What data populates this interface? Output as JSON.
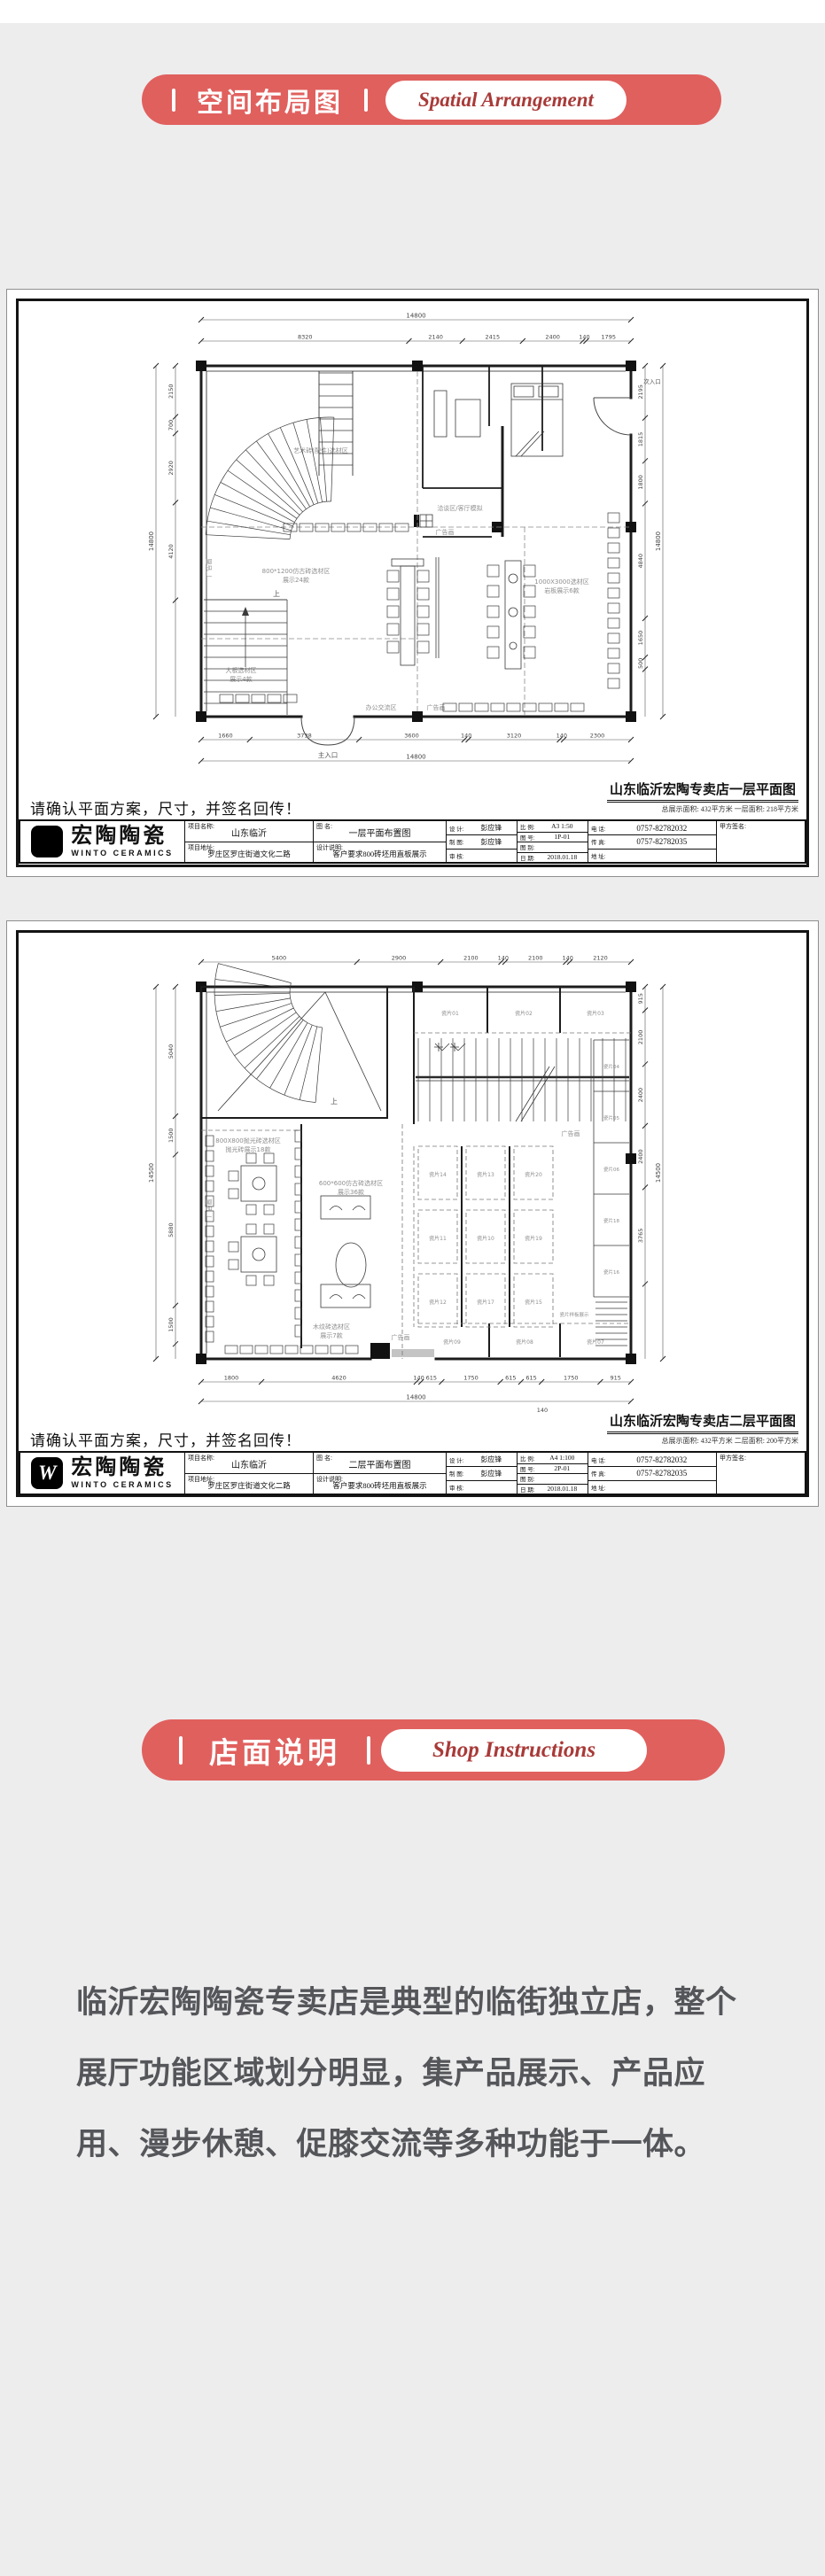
{
  "page": {
    "bg": "#ededee"
  },
  "colors": {
    "accent": "#e0605e",
    "accent_text": "#a83a38",
    "paragraph_text": "#55565a"
  },
  "banner_spatial": {
    "title_zh": "空间布局图",
    "title_en": "Spatial Arrangement"
  },
  "banner_shop": {
    "title_zh": "店面说明",
    "title_en": "Shop Instructions"
  },
  "company": {
    "name_zh": "宏陶陶瓷",
    "name_en": "WINTO CERAMICS",
    "logo_letter": "W"
  },
  "tbl": {
    "project_name": "项目名称:",
    "project_addr": "项目地址:",
    "drawing_name": "图  名:",
    "design_note": "设计说明:",
    "design": "设 计:",
    "draft": "制 图:",
    "review": "审 核:",
    "scale": "比 例:",
    "sheet_no": "图 号:",
    "sheet_type": "图 别:",
    "date": "日 期:",
    "phone": "电 话:",
    "fax": "传 真:",
    "addr": "地 址:",
    "client_sign": "甲方签名:"
  },
  "sheet1": {
    "confirm_note": "请确认平面方案，尺寸，并签名回传！",
    "drawing_title": "山东临沂宏陶专卖店一层平面图",
    "drawing_subtitle": "总展示面积: 432平方米  一层面积: 218平方米",
    "titleblock": {
      "project_name": "山东临沂",
      "project_addr": "罗庄区罗庄街道文化二路",
      "drawing_name": "一层平面布置图",
      "design_note": "客户要求800砖坯用直板展示",
      "design": "彭应锋",
      "draft": "彭应锋",
      "review": "",
      "scale": "A3 1:50",
      "sheet_no": "1P-01",
      "sheet_type": "",
      "date": "2018.01.18",
      "phone": "0757-82782032",
      "fax": "0757-82782035",
      "addr": "",
      "client_sign": ""
    },
    "plan": {
      "dim_top_total": "14800",
      "dims_top": [
        "8320",
        "2140",
        "2415",
        "2400",
        "140",
        "1795"
      ],
      "dims_bottom": [
        "1660",
        "3738",
        "3600",
        "140",
        "3120",
        "140",
        "2300"
      ],
      "dim_bottom_total": "14800",
      "dim_left_total": "14800",
      "dims_left": [
        "2150",
        "700",
        "2920",
        "4120"
      ],
      "dims_right": [
        "2195",
        "1815",
        "1800",
        "4840",
        "1650",
        "500"
      ],
      "dim_right_total": "14800",
      "labels": {
        "art": "艺术砖(配件)选材区",
        "talk": "洽谈区/客厅模拟",
        "antique": "800*1200仿古砖选材区",
        "antique2": "展示24款",
        "big": "1000X3000选材区",
        "big2": "岩板展示6款",
        "slab": "大板选材区",
        "slab2": "展示4款",
        "office": "办公交流区",
        "ad": "广告画",
        "main_entry": "主入口",
        "side_entry": "次入口",
        "up": "上"
      }
    }
  },
  "sheet2": {
    "confirm_note": "请确认平面方案，尺寸，并签名回传！",
    "drawing_title": "山东临沂宏陶专卖店二层平面图",
    "drawing_subtitle": "总展示面积: 432平方米  二层面积: 200平方米",
    "titleblock": {
      "project_name": "山东临沂",
      "project_addr": "罗庄区罗庄街道文化二路",
      "drawing_name": "二层平面布置图",
      "design_note": "客户要求800砖坯用直板展示",
      "design": "彭应锋",
      "draft": "彭应锋",
      "review": "",
      "scale": "A4 1:100",
      "sheet_no": "2P-01",
      "sheet_type": "",
      "date": "2018.01.18",
      "phone": "0757-82782032",
      "fax": "0757-82782035",
      "addr": "",
      "client_sign": ""
    },
    "plan": {
      "dims_top": [
        "5400",
        "2900",
        "2100",
        "140",
        "2100",
        "140",
        "2120"
      ],
      "dims_bottom": [
        "1800",
        "4620",
        "140",
        "615",
        "1750",
        "615",
        "615",
        "1750",
        "915"
      ],
      "dim_bottom_total": "14800",
      "dim_bottom_extra": "140",
      "dim_left_total": "14500",
      "dims_left": [
        "5040",
        "1500",
        "5880",
        "1500"
      ],
      "dims_right": [
        "915",
        "2100",
        "2400",
        "2400",
        "3765"
      ],
      "dim_right_total": "14500",
      "booths": [
        "瓷片01",
        "瓷片02",
        "瓷片03",
        "瓷片04",
        "瓷片05",
        "瓷片06",
        "瓷片07",
        "瓷片08",
        "瓷片09",
        "瓷片10",
        "瓷片11",
        "瓷片12",
        "瓷片13",
        "瓷片14",
        "瓷片15",
        "瓷片16",
        "瓷片17",
        "瓷片18",
        "瓷片19",
        "瓷片20"
      ],
      "labels": {
        "ad": "广告画",
        "polish": "800X800抛光砖选材区",
        "polish2": "抛光砖展示18款",
        "antique": "600*600仿古砖选材区",
        "antique2": "展示36款",
        "wood": "木纹砖选材区",
        "wood2": "展示7款",
        "display": "瓷片样板展示",
        "up": "上"
      }
    }
  },
  "paragraph": {
    "line1": "临沂宏陶陶瓷专卖店是典型的临街独立店，整个",
    "line2": "展厅功能区域划分明显，集产品展示、产品应",
    "line3": "用、漫步休憩、促膝交流等多种功能于一体。"
  }
}
